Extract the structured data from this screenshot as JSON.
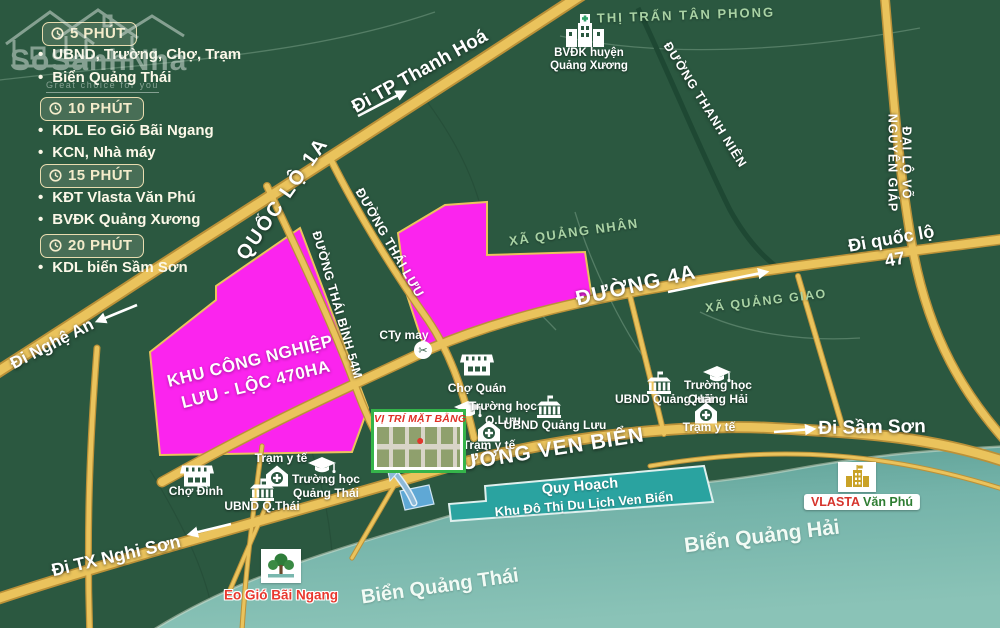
{
  "watermark": {
    "title": "SoSanhNha",
    "tagline": "Great choice for you"
  },
  "legend": {
    "groups": [
      {
        "time": "5 PHÚT",
        "items": [
          "UBND, Trường, Chợ, Trạm",
          "Biển Quảng Thái"
        ]
      },
      {
        "time": "10 PHÚT",
        "items": [
          "KDL Eo Gió Bãi Ngang",
          "KCN, Nhà máy"
        ]
      },
      {
        "time": "15 PHÚT",
        "items": [
          "KĐT Vlasta Văn Phú",
          "BVĐK Quảng Xương"
        ]
      },
      {
        "time": "20 PHÚT",
        "items": [
          "KDL biển Sầm Sơn"
        ]
      }
    ]
  },
  "roads": {
    "ql1a": "QUỐC LỘ 1A",
    "thai_binh": "ĐƯỜNG THÁI BÌNH 54M",
    "thai_luu": "ĐƯỜNG THÁI LƯU",
    "d4a": "ĐƯỜNG 4A",
    "ven_bien": "ĐƯỜNG VEN BIỂN",
    "thanh_nien": "ĐƯỜNG THANH NIÊN",
    "vo_nguyen_giap": "ĐẠI LỘ VÕ NGUYÊN GIÁP"
  },
  "directions": {
    "thanh_hoa": "Đi TP Thanh Hoá",
    "quoc_lo_47": "Đi quốc lộ 47",
    "nghe_an": "Đi Nghệ An",
    "nghi_son": "Đi TX Nghi Sơn",
    "sam_son": "Đi Sầm Sơn"
  },
  "areas": {
    "tan_phong": "THỊ TRẤN TÂN PHONG",
    "quang_nhan": "XÃ QUẢNG NHÂN",
    "quang_giao": "XÃ QUẢNG GIAO"
  },
  "sea": {
    "quang_thai": "Biển Quảng Thái",
    "quang_hai": "Biển Quảng Hải"
  },
  "zones": {
    "kcn": "KHU CÔNG NGHIỆP\nLƯU - LỘC 470HA"
  },
  "site": {
    "title": "VỊ TRÍ MẶT BẰNG"
  },
  "banner": {
    "line1": "Quy Hoạch",
    "line2": "Khu Đô Thị Du Lịch Ven Biển"
  },
  "landmarks": {
    "bvdk": "BVĐK huyện\nQuảng Xương",
    "cho_quan": "Chợ Quán",
    "truong_hoc_qluu": "Trường học\nQ.Lưu",
    "ubnd_quang_luu": "UBND Quảng Lưu",
    "tram_y_te": "Trạm y tế",
    "ubnd_quang_hai": "UBND Quảng Hải",
    "truong_hoc_qhai": "Trường học\nQuảng Hải",
    "cho_dinh": "Chợ Đình",
    "ubnd_qthai": "UBND Q.Thái",
    "truong_hoc_qthai": "Trường học\nQuảng Thái",
    "cty_may": "CTy may",
    "vlasta_brand": "VLASTA",
    "vlasta_name": "Văn Phú",
    "eo_gio": "Eo Gió Bãi Ngang"
  },
  "colors": {
    "land": "#2b5840",
    "road": "#eac35c",
    "industrial_pink": "#fb24ee",
    "sea": "#7db9ae",
    "banner_teal": "#2aa3a0",
    "accent_red": "#e03026"
  }
}
